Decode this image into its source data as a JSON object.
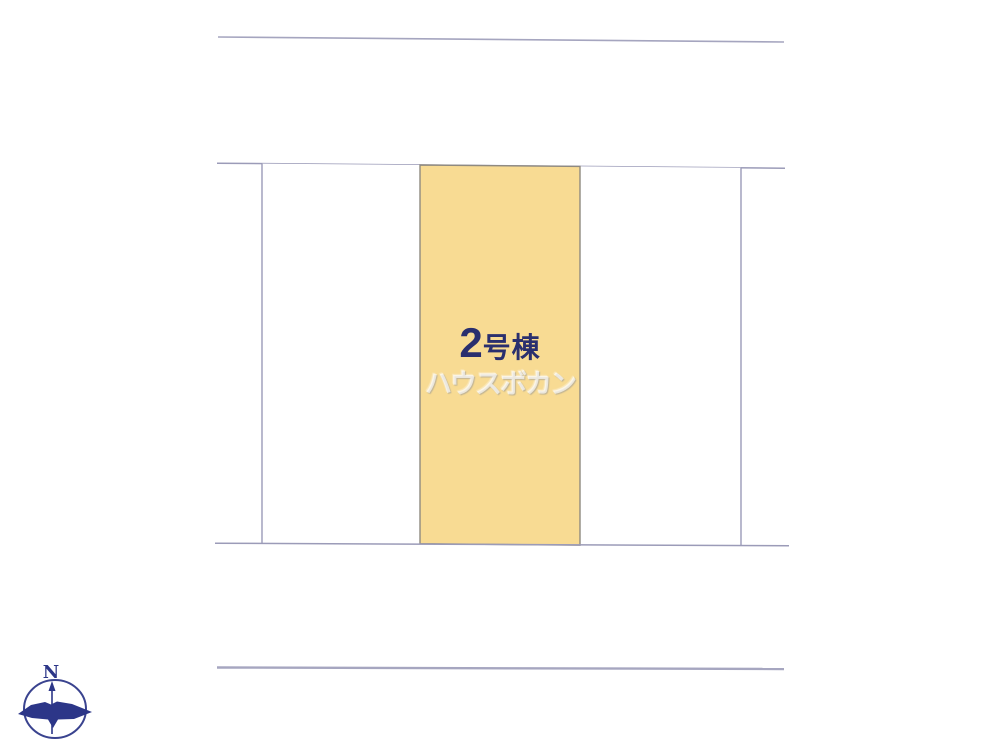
{
  "diagram": {
    "type": "real-estate-site-plan",
    "parcels": [
      {
        "id": "left",
        "label": "",
        "highlighted": false
      },
      {
        "id": "center",
        "label": "2号棟",
        "number": "2",
        "suffix": "号棟",
        "highlighted": true,
        "fill": "#F8DB93"
      },
      {
        "id": "right",
        "label": "",
        "highlighted": false
      }
    ],
    "watermark": "ハウスボカン",
    "compass": {
      "north_label": "N"
    }
  },
  "colors": {
    "background": "#FFFFFF",
    "boundary_line": "#9B9BB8",
    "road_line_top": "#A5A5BF",
    "road_line_bottom": "#A6A6C0",
    "highlight_fill": "#F8DB93",
    "highlight_border": "#8F8A80",
    "label_navy": "#2A2F6E",
    "compass_navy": "#2C3688",
    "watermark_white": "#FFFFFF"
  }
}
